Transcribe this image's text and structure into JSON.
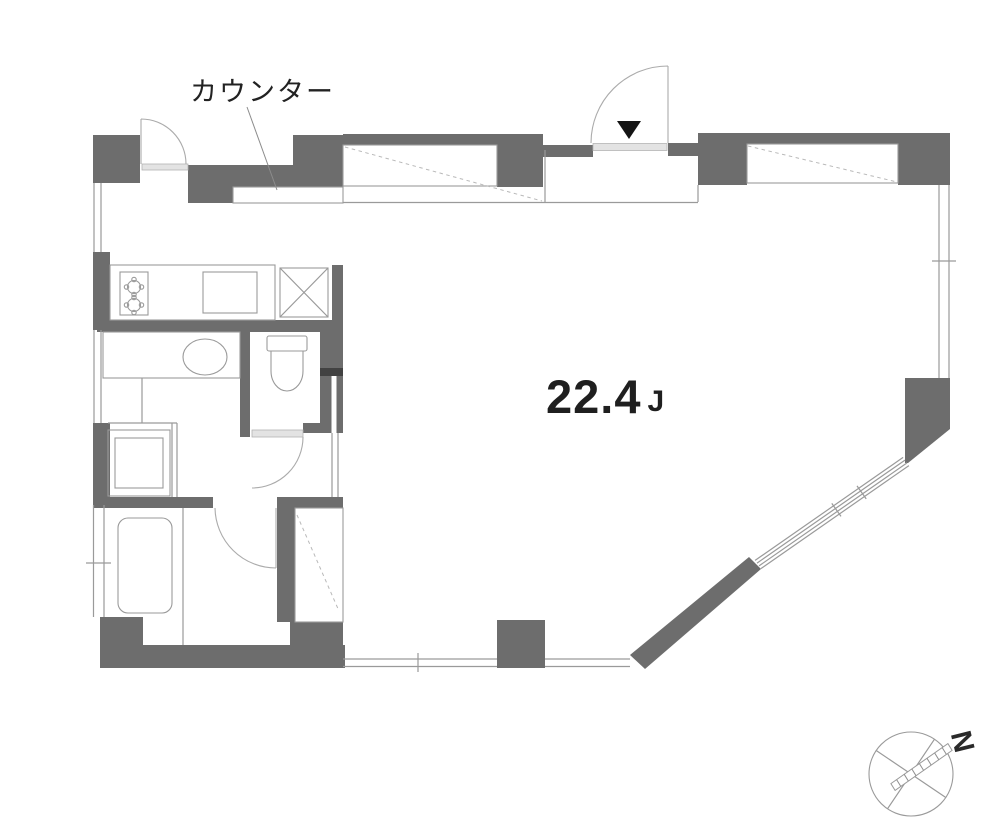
{
  "plan": {
    "counter_label": "カウンター",
    "area": {
      "value": "22.4",
      "unit": "J"
    },
    "compass": {
      "north_label": "N"
    },
    "colors": {
      "wall": "#6d6d6d",
      "line": "#9a9a9a",
      "dash": "#b9b9b9",
      "sill": "#e3e3e3",
      "text": "#1f1f1f"
    }
  }
}
